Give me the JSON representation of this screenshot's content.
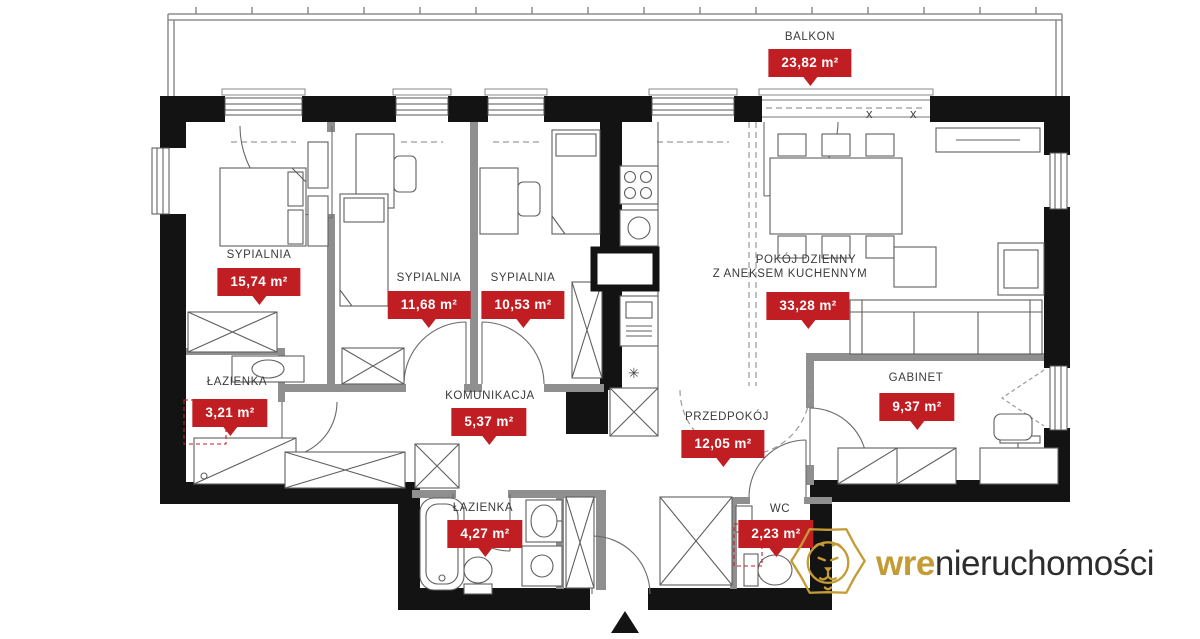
{
  "colors": {
    "badge_red": "#c11e23",
    "wall_black": "#131313",
    "interior_gray": "#8f8f8f",
    "logo_gold": "#c49b35",
    "logo_dark": "#2d2d2d",
    "label_text": "#3b3b3b"
  },
  "rooms": {
    "balkon": {
      "name": "BALKON",
      "area": "23,82 m²"
    },
    "sypialnia_1": {
      "name": "SYPIALNIA",
      "area": "15,74 m²"
    },
    "sypialnia_2": {
      "name": "SYPIALNIA",
      "area": "11,68 m²"
    },
    "sypialnia_3": {
      "name": "SYPIALNIA",
      "area": "10,53 m²"
    },
    "pokoj_dzienny": {
      "name_line1": "POKÓJ DZIENNY",
      "name_line2": "Z ANEKSEM KUCHENNYM",
      "area": "33,28 m²"
    },
    "lazienka_1": {
      "name": "ŁAZIENKA",
      "area": "3,21 m²"
    },
    "komunikacja": {
      "name": "KOMUNIKACJA",
      "area": "5,37 m²"
    },
    "przedpokoj": {
      "name": "PRZEDPOKÓJ",
      "area": "12,05 m²"
    },
    "gabinet": {
      "name": "GABINET",
      "area": "9,37 m²"
    },
    "lazienka_2": {
      "name": "ŁAZIENKA",
      "area": "4,27 m²"
    },
    "wc": {
      "name": "WC",
      "area": "2,23 m²"
    }
  },
  "symbols": {
    "door_mark_1": "x",
    "door_mark_2": "x",
    "kitchen_star": "✳"
  },
  "logo": {
    "brand_bold": "wre",
    "brand_light": "nieruchomości"
  }
}
